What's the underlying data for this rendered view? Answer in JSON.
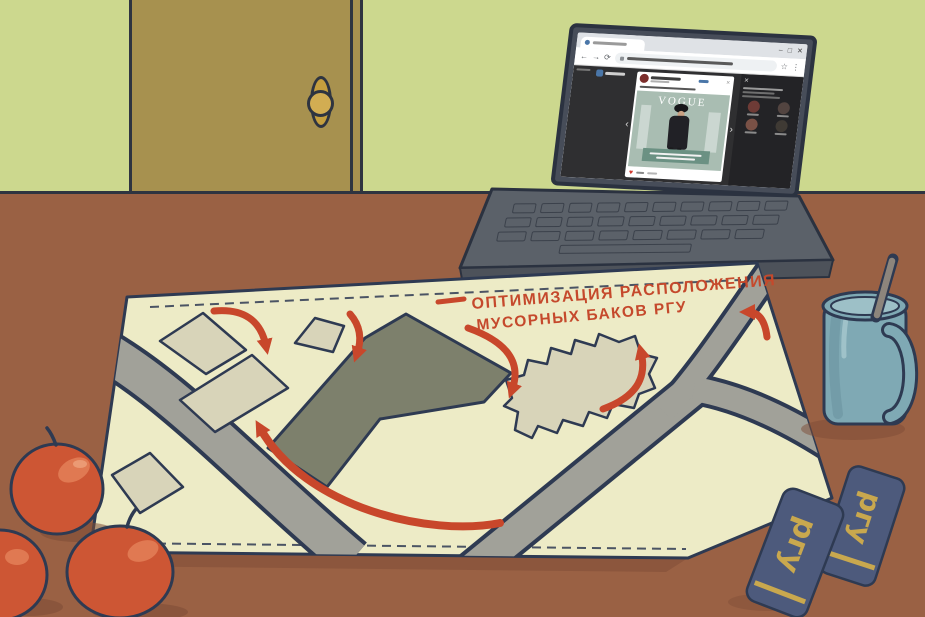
{
  "room": {
    "wall_color": "#ccd88e",
    "door_color": "#a7914f",
    "floor_color": "#9a6144",
    "outline_color": "#2e3440"
  },
  "map": {
    "title_line1": "ОПТИМИЗАЦИЯ РАСПОЛОЖЕНИЯ",
    "title_line2": "МУСОРНЫХ БАКОВ РГУ",
    "title_color": "#c5492c",
    "paper_color": "#edebc6",
    "road_color": "#a1a199",
    "building_color": "#d8d4b9",
    "main_building_color": "#7d806c",
    "arrow_color": "#c8472b"
  },
  "laptop": {
    "body_color": "#5b6169",
    "browser": {
      "window_controls": {
        "minimize": "–",
        "maximize": "□",
        "close": "✕"
      },
      "nav": {
        "back": "←",
        "forward": "→",
        "reload": "⟳",
        "star": "☆",
        "menu": "⋮"
      },
      "lightbox": {
        "prev": "‹",
        "next": "›",
        "close": "✕"
      },
      "post": {
        "magazine_title": "VOGUE",
        "like_icon": "♥"
      }
    }
  },
  "objects": {
    "apples_color": "#cd5634",
    "mug_color": "#7fa9b4",
    "notebook_label": "ргу",
    "notebook_color": "#4d5a7c",
    "notebook_text_color": "#c9a84e"
  }
}
